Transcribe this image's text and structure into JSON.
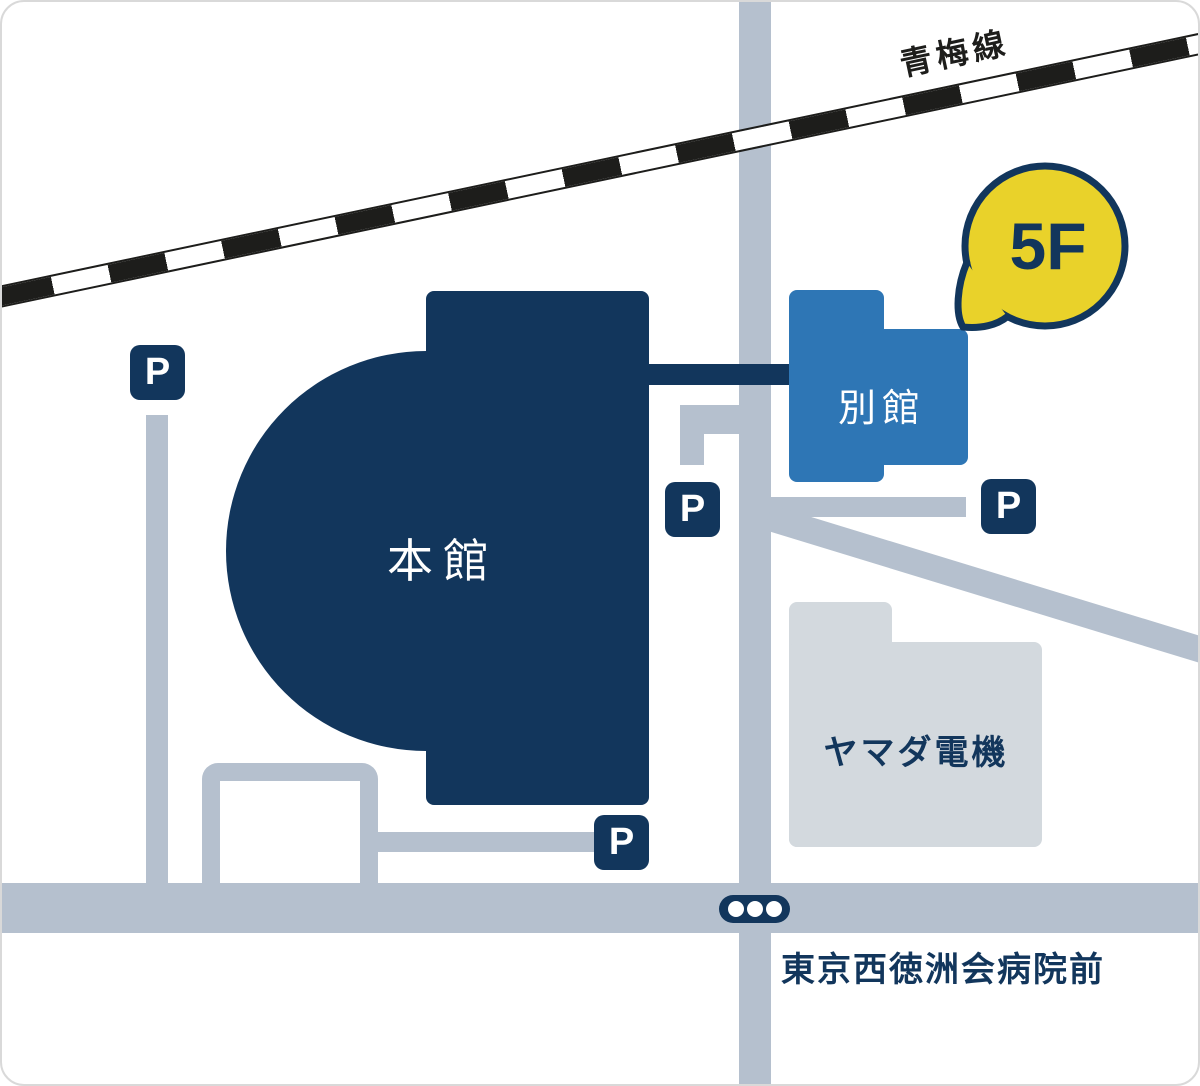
{
  "map": {
    "railway": {
      "label": "青梅線"
    },
    "buildings": {
      "main": {
        "label": "本館",
        "color": "#12365c"
      },
      "annex": {
        "label": "別館",
        "color": "#2e76b5"
      },
      "yamada": {
        "label": "ヤマダ電機",
        "color": "#d3d9de"
      }
    },
    "floor_badge": {
      "label": "5F",
      "bg_color": "#e9d22a",
      "border_color": "#12365c"
    },
    "parking": [
      {
        "label": "P"
      },
      {
        "label": "P"
      },
      {
        "label": "P"
      },
      {
        "label": "P"
      }
    ],
    "bus_stop": {
      "name": "東京西徳洲会病院前",
      "dots": 3
    },
    "colors": {
      "navy": "#12365c",
      "road": "#b5c0ce",
      "rail_black": "#1d1d1b",
      "background": "#ffffff"
    }
  }
}
